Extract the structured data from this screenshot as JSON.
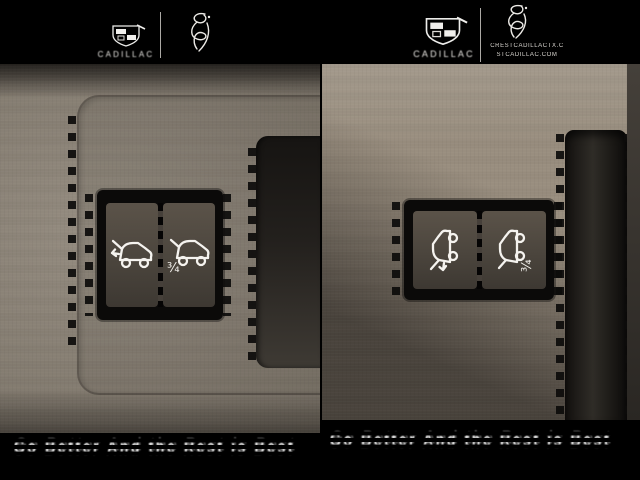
{
  "header": {
    "left": {
      "brand": "CADILLAC"
    },
    "right": {
      "brand": "CADILLAC",
      "dealer_url_line1": "CRESTCADILLACTX.C",
      "dealer_url_line2": "STCADILLAC.COM"
    }
  },
  "caption": {
    "left_text": "Go Better And the Rest is Best",
    "right_text": "Go Better And the Rest is Best"
  },
  "buttons": {
    "left_photo": [
      {
        "name": "liftgate-open-button",
        "icon": "suv-liftgate-open-arrow"
      },
      {
        "name": "liftgate-partial-button",
        "icon": "suv-liftgate-three-quarter",
        "fraction": "¾"
      }
    ],
    "right_photo": [
      {
        "name": "liftgate-open-button",
        "icon": "suv-liftgate-open-arrow"
      },
      {
        "name": "liftgate-partial-button",
        "icon": "suv-liftgate-three-quarter",
        "fraction": "¾"
      }
    ]
  },
  "colors": {
    "header_bg": "#000000",
    "leather_left": "#8d8477",
    "leather_right": "#998e7f",
    "panel_dark": "#3a3632",
    "bezel_black": "#0b0a09",
    "button_face": "#4e4941",
    "icon_white": "#f5f3ef",
    "caption_text": "#ffffff"
  }
}
